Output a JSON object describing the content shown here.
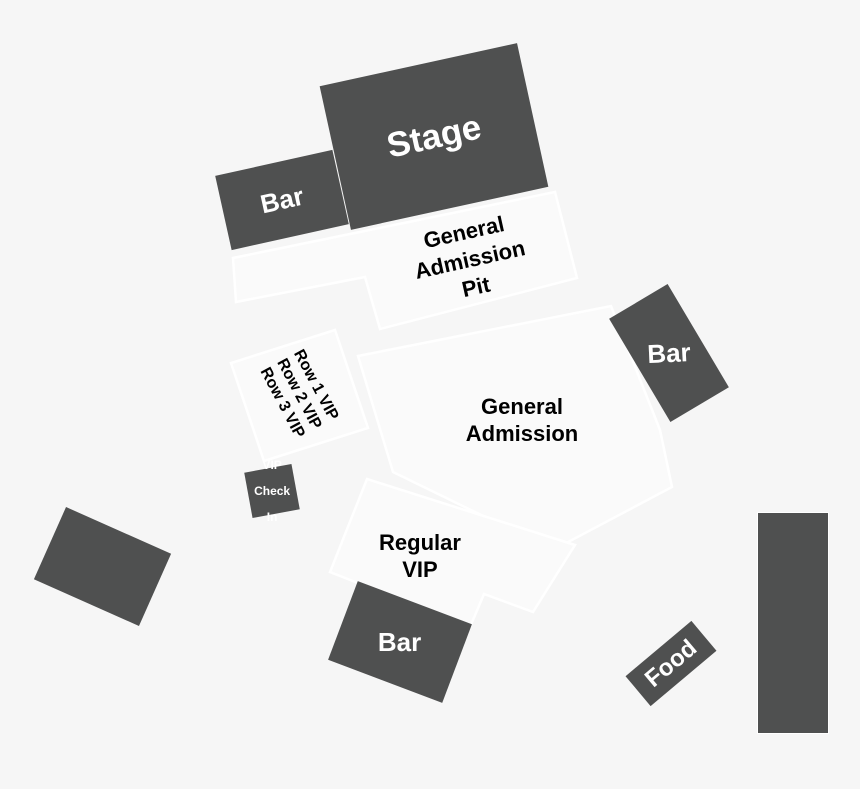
{
  "colors": {
    "background": "#f6f6f6",
    "dark_shape": "#4f5050",
    "light_region_fill": "#fafafa",
    "region_outline": "#ffffff",
    "label_on_dark": "#ffffff",
    "label_on_light": "#000000"
  },
  "map": {
    "stage": {
      "label": "Stage"
    },
    "bar_upper_left": {
      "label": "Bar"
    },
    "bar_right": {
      "label": "Bar"
    },
    "bar_bottom": {
      "label": "Bar"
    },
    "food": {
      "label": "Food"
    },
    "vip_check_in": {
      "line1": "VIP",
      "line2": "Check",
      "line3": "In"
    },
    "ga_pit": {
      "line1": "General",
      "line2": "Admission",
      "line3": "Pit"
    },
    "general_admission": {
      "line1": "General",
      "line2": "Admission"
    },
    "regular_vip": {
      "line1": "Regular",
      "line2": "VIP"
    },
    "vip_rows": {
      "row1": "Row 1 VIP",
      "row2": "Row 2 VIP",
      "row3": "Row 3 VIP"
    }
  }
}
